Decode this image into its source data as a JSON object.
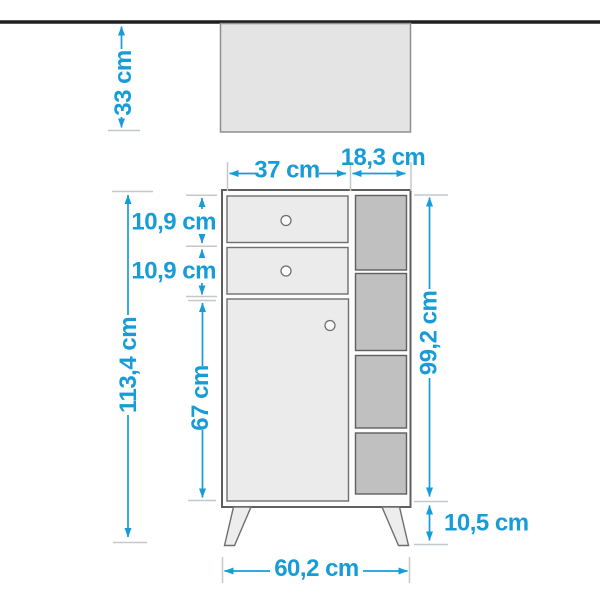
{
  "diagram": {
    "type": "furniture-dimension-drawing",
    "unit": "cm",
    "labels": {
      "wall_clearance": "33 cm",
      "drawer_section_width": "37 cm",
      "shelf_section_width": "18,3 cm",
      "top_drawer_height": "10,9 cm",
      "second_drawer_height": "10,9 cm",
      "overall_height": "113,4 cm",
      "door_height": "67 cm",
      "carcass_height": "99,2 cm",
      "leg_height": "10,5 cm",
      "overall_width": "60,2 cm"
    },
    "measurements_cm": {
      "wall_clearance": 33,
      "drawer_section_width": 37,
      "shelf_section_width": 18.3,
      "top_drawer_height": 10.9,
      "second_drawer_height": 10.9,
      "overall_height": 113.4,
      "door_height": 67,
      "carcass_height": 99.2,
      "leg_height": 10.5,
      "overall_width": 60.2
    },
    "colors": {
      "dimension_accent": "#189cd8",
      "extension_tick": "#c3c8cc",
      "wall_line": "#1e1e1e",
      "panel_fill": "#e4e4e4",
      "front_fill": "#ebebeb",
      "cubby_fill": "#c0c0c0"
    }
  }
}
